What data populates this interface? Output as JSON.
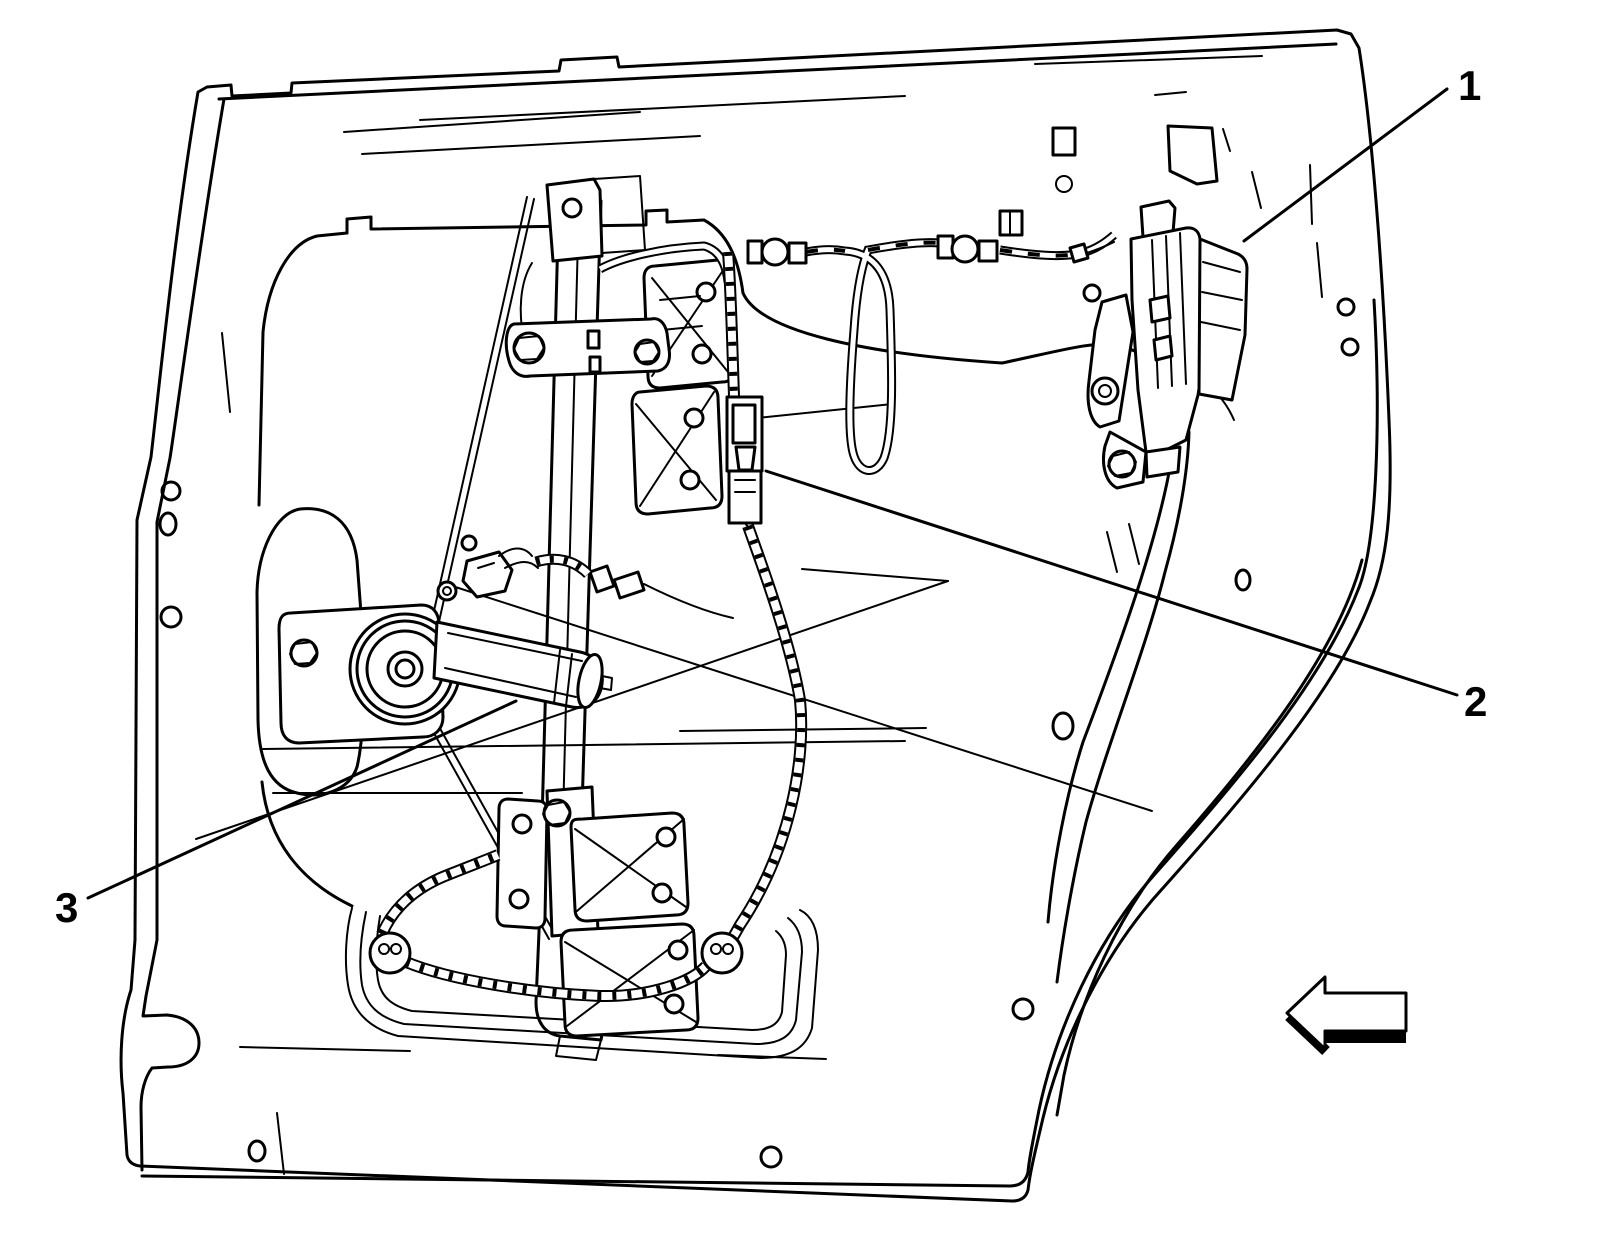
{
  "figure": {
    "background_color": "#ffffff",
    "line_color": "#000000",
    "callouts": [
      {
        "label": "1"
      },
      {
        "label": "2"
      },
      {
        "label": "3"
      }
    ],
    "icons": {
      "direction_arrow": "left-pointing block arrow"
    }
  }
}
